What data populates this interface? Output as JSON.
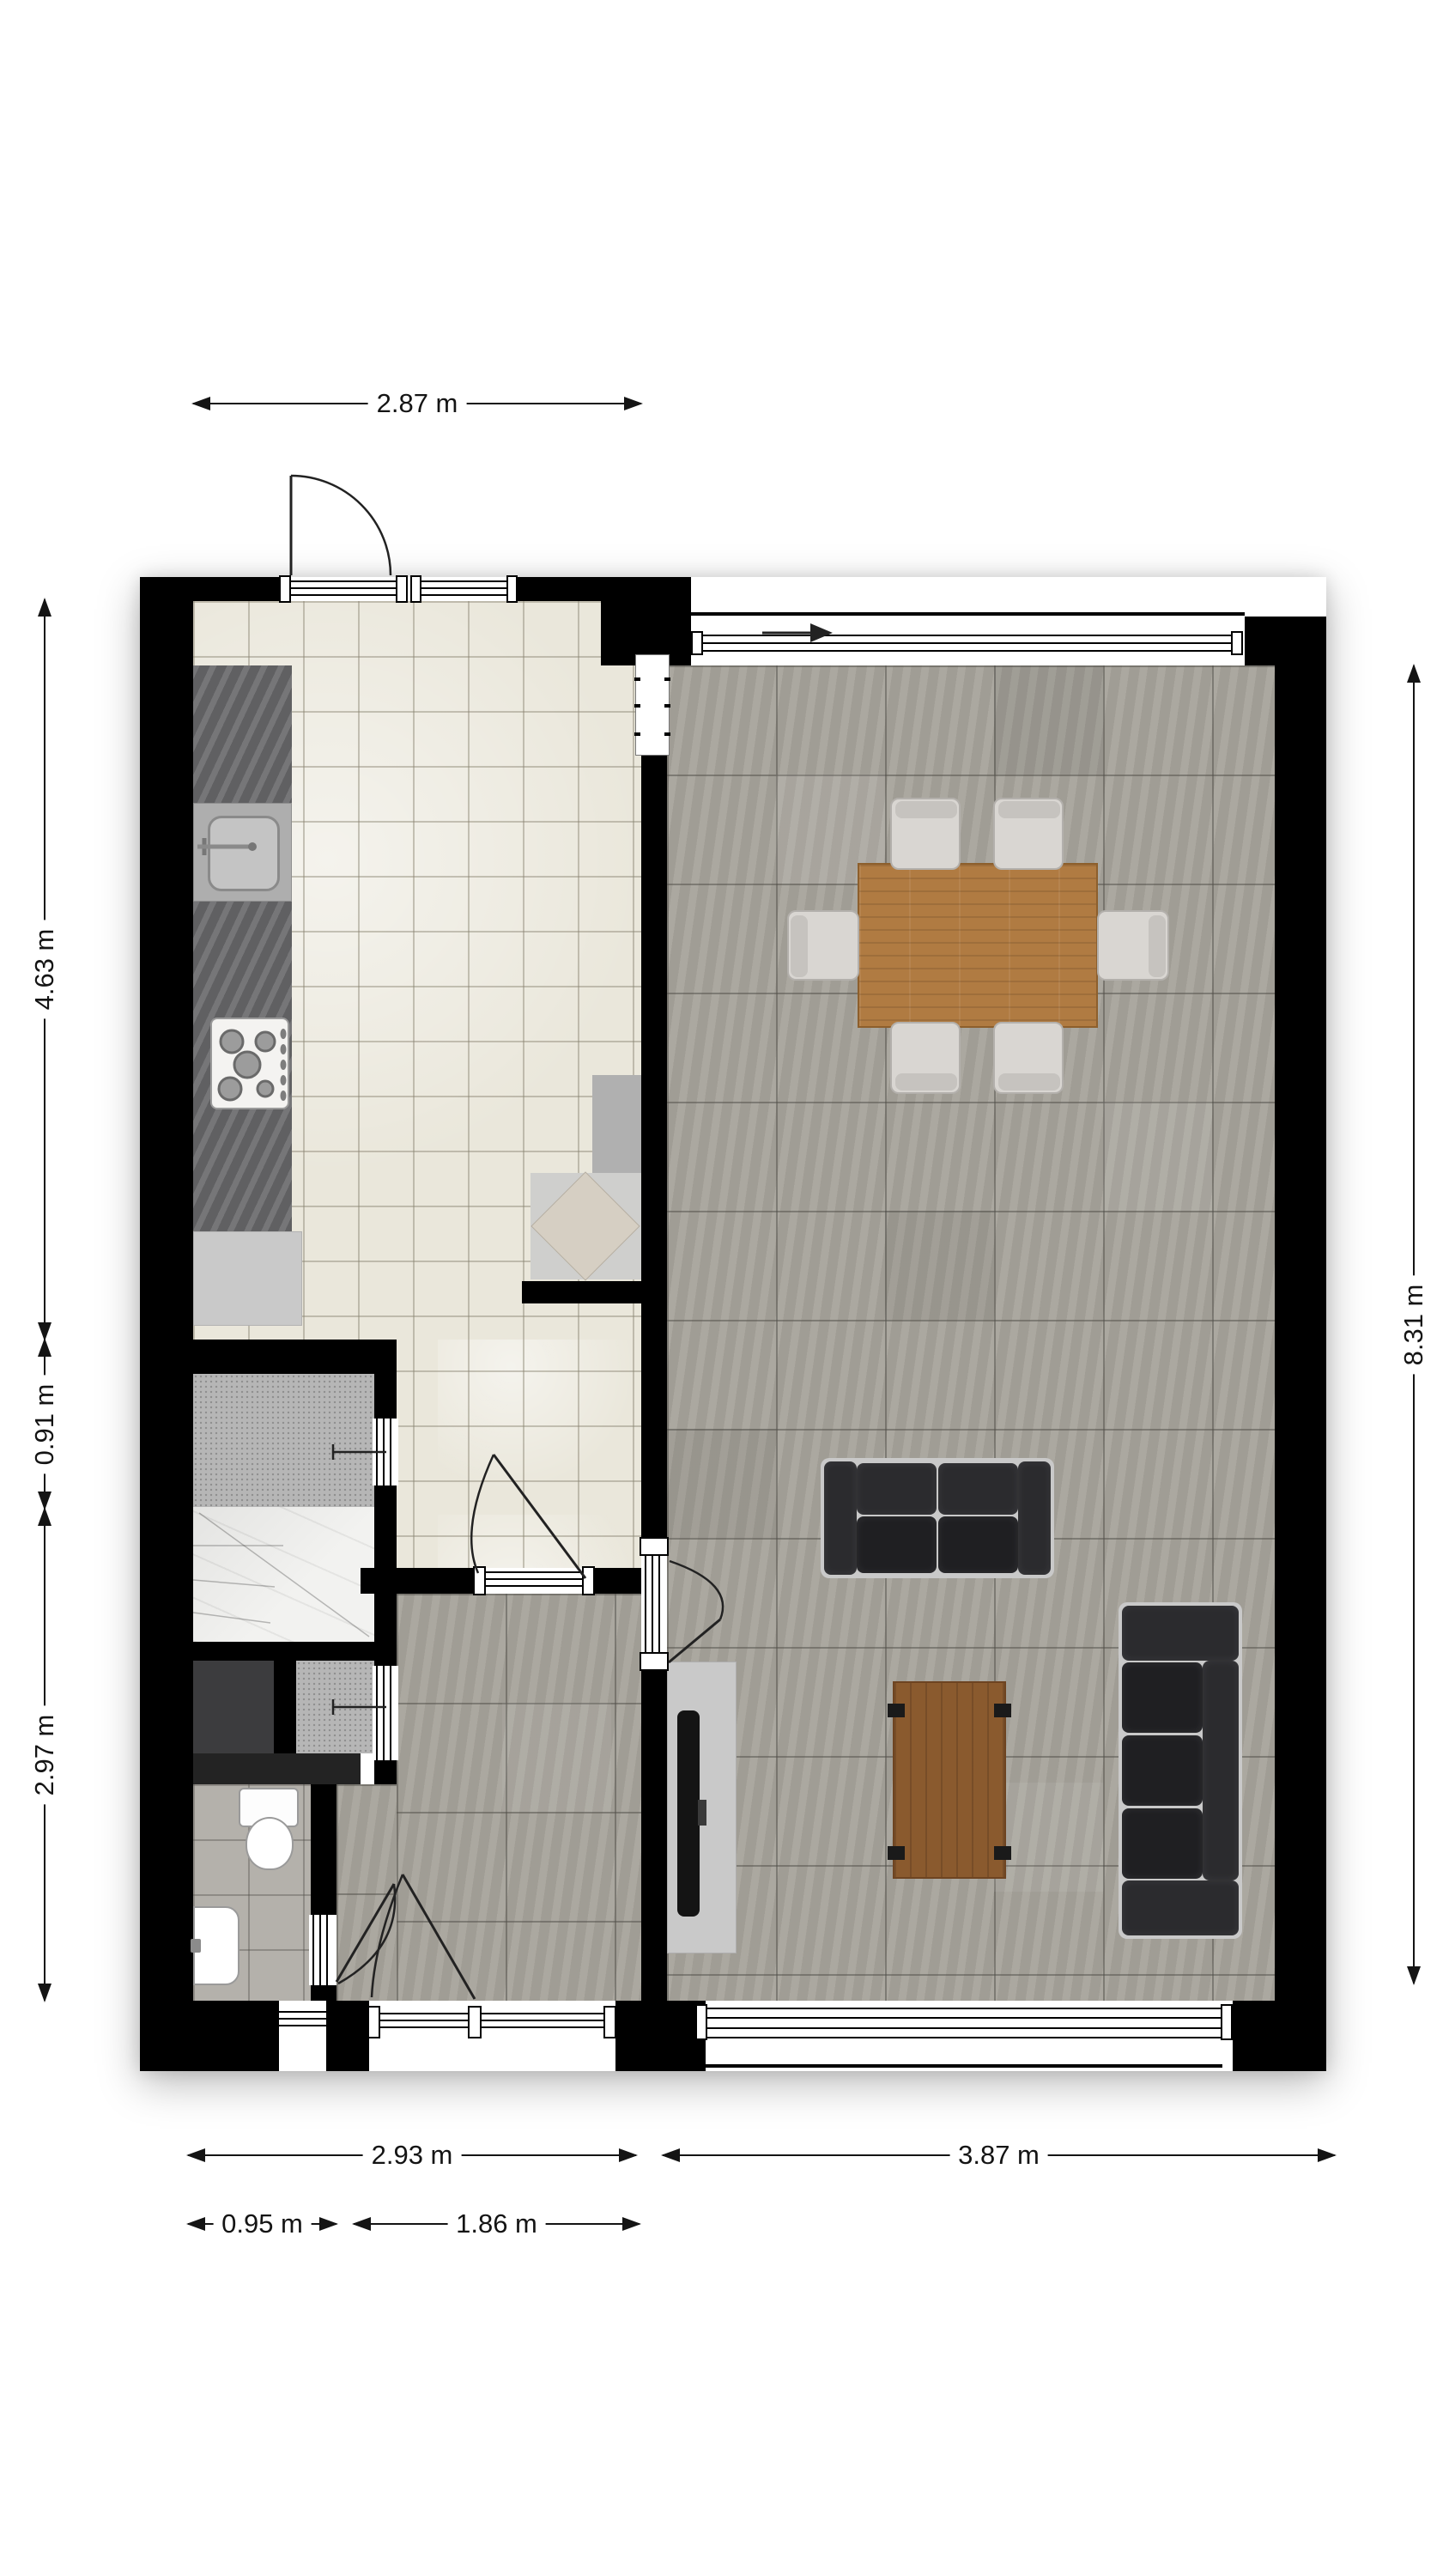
{
  "dimensions": {
    "top": "2.87 m",
    "left_upper": "4.63 m",
    "left_mid": "0.91 m",
    "left_lower": "2.97 m",
    "right": "8.31 m",
    "bottom_left": "2.93 m",
    "bottom_right": "3.87 m",
    "bottom_toilet": "0.95 m",
    "bottom_hall": "1.86 m"
  },
  "colors": {
    "wall": "#000000",
    "kitchen_floor": "#eae7db",
    "concrete_floor": "#a7a39b",
    "closet_floor": "#b6b6b6",
    "stairs_floor": "#f2f2f0",
    "counter": "#6d6d70",
    "dining_table_wood": "#b07b42",
    "coffee_table_wood": "#8a5a2e",
    "sofa_leather": "#2b2b2e",
    "chair_fabric": "#d9d6d2",
    "corner_unit": "#d6cfc3",
    "dimension_text": "#141414"
  },
  "icons": {
    "entrance_arrow": "right-arrow",
    "door_swings": "quarter-arc"
  }
}
